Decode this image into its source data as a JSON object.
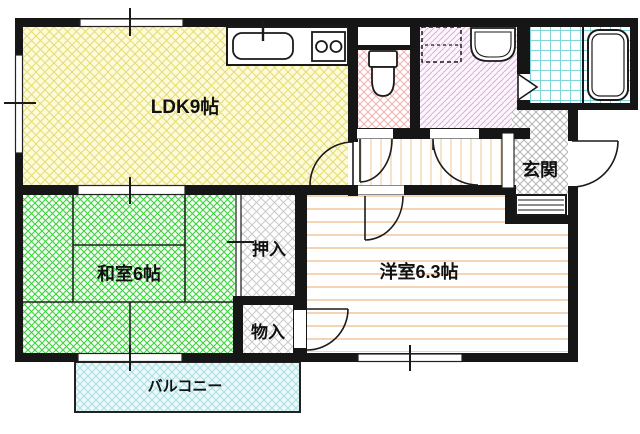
{
  "plan": {
    "type": "japanese-apartment-floor-plan",
    "colors": {
      "wall": "#161616",
      "line": "#1f1f1f",
      "window_fill": "#ffffff"
    },
    "rooms": {
      "ldk": {
        "label": "LDK9帖",
        "bg": "#fdfbda",
        "hatch": "#e6dc79"
      },
      "washitsu": {
        "label": "和室6帖",
        "bg": "#f6fff6",
        "hatch": "#3fd03f"
      },
      "yoshitsu": {
        "label": "洋室6.3帖",
        "bg": "#ffffff",
        "hatch": "#f0c193"
      },
      "oshiire": {
        "label": "押入",
        "bg": "#ffffff",
        "hatch": "#c9c9c9"
      },
      "monoire": {
        "label": "物入",
        "bg": "#ffffff",
        "hatch": "#c9c9c9"
      },
      "genkan": {
        "label": "玄関",
        "bg": "#ffffff",
        "hatch": "#b5b5b5"
      },
      "balcony": {
        "label": "バルコニー",
        "bg": "#ebf9fa",
        "hatch": "#a9dde3"
      },
      "toilet": {
        "bg": "#ffffff",
        "hatch": "#f2b0b0"
      },
      "washroom": {
        "bg": "#fdf6fd",
        "hatch": "#dcaedc"
      },
      "bathroom": {
        "bg": "#ffffff",
        "hatch": "#7fd5d8"
      },
      "hallway": {
        "bg": "#ffffff",
        "hatch": "#f2cfa6"
      }
    }
  }
}
